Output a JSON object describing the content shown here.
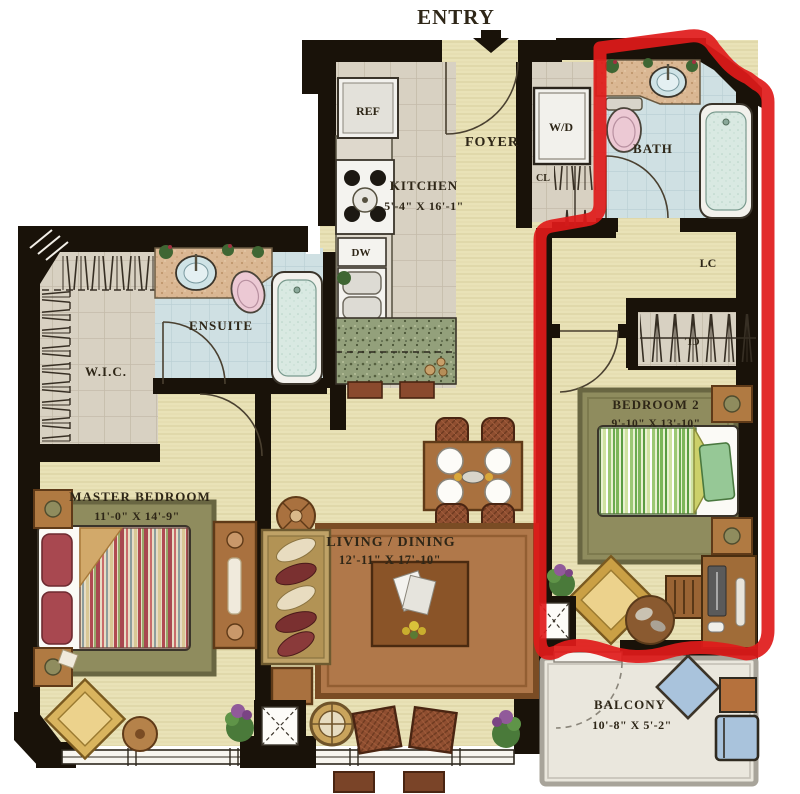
{
  "page": {
    "title": "Apartment Floor Plan"
  },
  "entry": {
    "label": "ENTRY"
  },
  "rooms": {
    "kitchen": {
      "label": "KITCHEN",
      "dims": "5'-4\" X 16'-1\""
    },
    "foyer": {
      "label": "FOYER"
    },
    "bath": {
      "label": "BATH"
    },
    "linen_closet": {
      "label": "LC"
    },
    "foyer_closet": {
      "label": "CL"
    },
    "bedroom2_closet": {
      "label": "CL"
    },
    "bedroom2": {
      "label": "BEDROOM 2",
      "dims": "9'-10\" X 13'-10\""
    },
    "ensuite": {
      "label": "ENSUITE"
    },
    "wic": {
      "label": "W.I.C."
    },
    "master_bedroom": {
      "label": "MASTER BEDROOM",
      "dims": "11'-0\" X 14'-9\""
    },
    "living_dining": {
      "label": "LIVING / DINING",
      "dims": "12'-11\" X 17'-10\""
    },
    "balcony": {
      "label": "BALCONY",
      "dims": "10'-8\" X 5'-2\""
    }
  },
  "appliances": {
    "fridge": "REF",
    "dishwasher": "DW",
    "washer_dryer": "W/D"
  },
  "highlight": {
    "color": "#e01a1a"
  },
  "colors": {
    "wall": "#191209",
    "floor_main": "#e9e2b7",
    "floor_tile": "#d8d1c2",
    "floor_bath": "#cfe0e3",
    "rug_living": "#b0784a",
    "rug_bedroom": "#8f8c5e",
    "wood": "#a9713f",
    "balcony_floor": "#eae7dd"
  }
}
